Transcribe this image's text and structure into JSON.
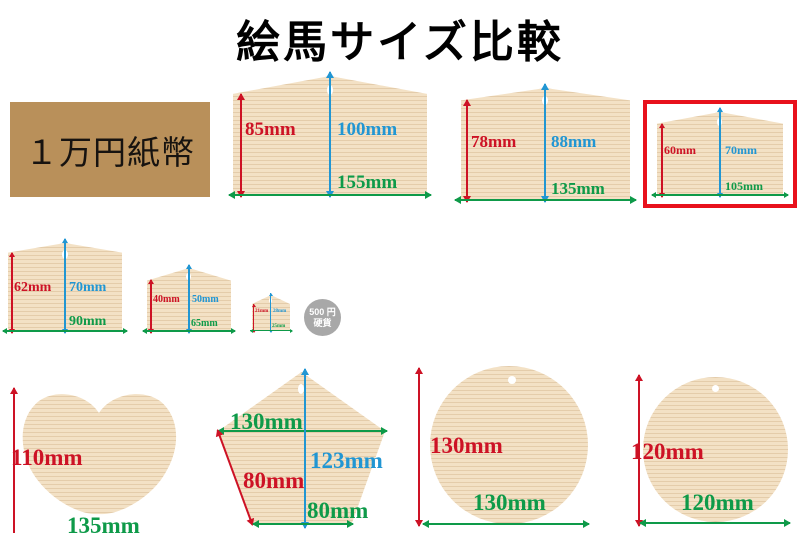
{
  "title": "絵馬サイズ比較",
  "banknote": {
    "label": "１万円紙幣"
  },
  "coin": {
    "line1": "500 円",
    "line2": "硬貨"
  },
  "colors": {
    "red": "#cd1225",
    "blue": "#2196d3",
    "green": "#0e9a49",
    "wood": "#f3e1c5",
    "banknote": "#b9905a",
    "coin": "#a8a8a8",
    "highlight": "#e8111c"
  },
  "plaques": [
    {
      "side": "85mm",
      "height": "100mm",
      "width": "155mm"
    },
    {
      "side": "78mm",
      "height": "88mm",
      "width": "135mm"
    },
    {
      "side": "60mm",
      "height": "70mm",
      "width": "105mm",
      "highlighted": true
    },
    {
      "side": "62mm",
      "height": "70mm",
      "width": "90mm"
    },
    {
      "side": "40mm",
      "height": "50mm",
      "width": "65mm"
    },
    {
      "side": "21mm",
      "height": "28mm",
      "width": "25mm"
    }
  ],
  "heart": {
    "height": "110mm",
    "width": "135mm"
  },
  "pentagon": {
    "width": "130mm",
    "height": "123mm",
    "side": "80mm",
    "bottom": "80mm"
  },
  "circles": [
    {
      "height": "130mm",
      "width": "130mm"
    },
    {
      "height": "120mm",
      "width": "120mm"
    }
  ]
}
